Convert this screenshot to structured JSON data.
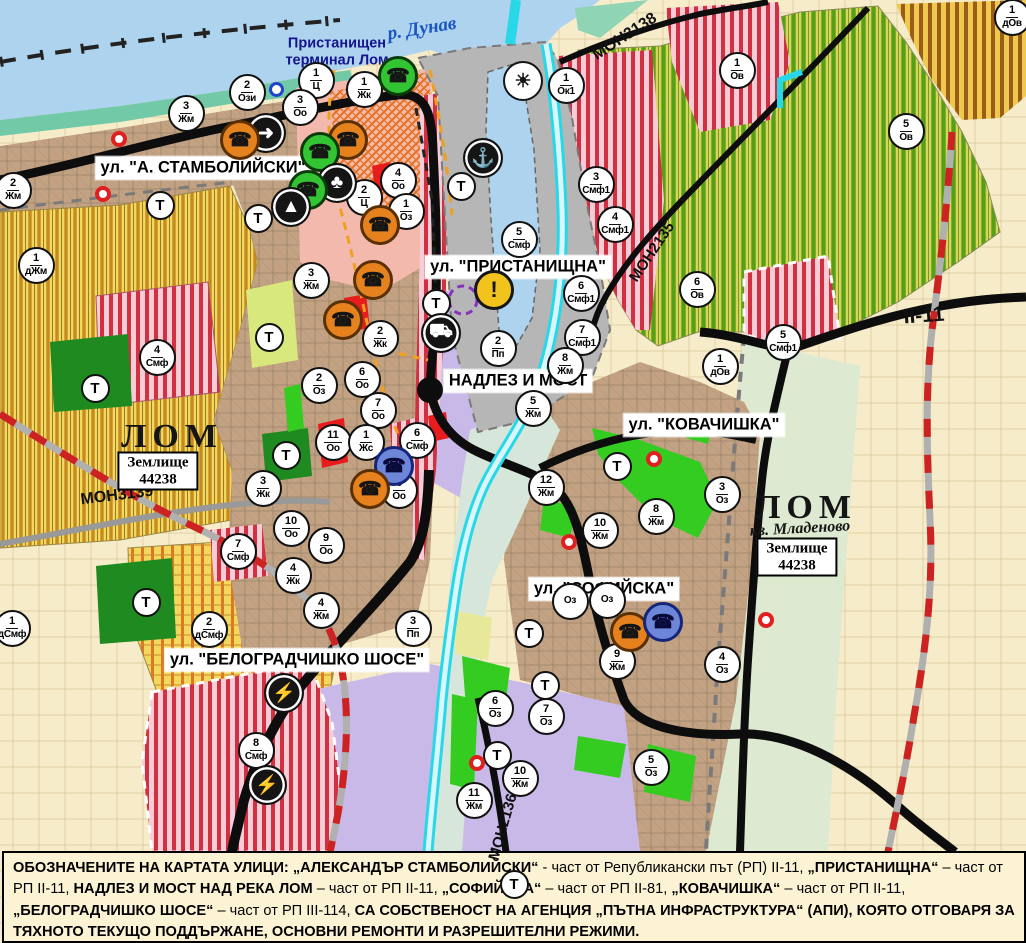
{
  "map": {
    "street_labels": [
      {
        "text": "ул. \"А. СТАМБОЛИЙСКИ\"",
        "x": 203,
        "y": 168
      },
      {
        "text": "ул. \"ПРИСТАНИЩНА\"",
        "x": 518,
        "y": 267
      },
      {
        "text": "НАДЛЕЗ И МОСТ",
        "x": 518,
        "y": 381
      },
      {
        "text": "ул. \"КОВАЧИШКА\"",
        "x": 704,
        "y": 425
      },
      {
        "text": "ул. \"СОФИЙСКА\"",
        "x": 604,
        "y": 589
      },
      {
        "text": "ул. \"БЕЛОГРАДЧИШКО ШОСЕ\"",
        "x": 297,
        "y": 660
      }
    ],
    "place_labels": [
      {
        "kind": "river",
        "text": "р. Дунав",
        "x": 422,
        "y": 29,
        "rot": -9
      },
      {
        "kind": "terminal",
        "text": "Пристанищен\nтерминал Лом",
        "x": 337,
        "y": 52,
        "rot": 0
      },
      {
        "kind": "city",
        "text": "ЛОМ",
        "x": 172,
        "y": 437,
        "rot": 0
      },
      {
        "kind": "city",
        "text": "ЛОМ",
        "x": 806,
        "y": 508,
        "rot": 0
      },
      {
        "kind": "district",
        "text": "кв. Младеново",
        "x": 800,
        "y": 529,
        "rot": -3
      }
    ],
    "road_labels": [
      {
        "text": "МОН3138",
        "x": 625,
        "y": 37,
        "rot": -33,
        "size": 16
      },
      {
        "text": "МОН2135",
        "x": 652,
        "y": 252,
        "rot": -56,
        "size": 15
      },
      {
        "text": "МОН3139",
        "x": 117,
        "y": 496,
        "rot": -7,
        "size": 16
      },
      {
        "text": "МОН2136",
        "x": 503,
        "y": 827,
        "rot": -74,
        "size": 15
      },
      {
        "text": "II-11",
        "x": 924,
        "y": 316,
        "rot": -4,
        "size": 21
      }
    ],
    "area_boxes": [
      {
        "lines": [
          "Землище",
          "44238"
        ],
        "x": 158,
        "y": 471
      },
      {
        "lines": [
          "Землище",
          "44238"
        ],
        "x": 797,
        "y": 557
      }
    ],
    "t_label": "Т",
    "zone_badges": [
      {
        "n": "2",
        "c": "Ози",
        "x": 247,
        "y": 92
      },
      {
        "n": "1",
        "c": "Ц",
        "x": 316,
        "y": 80
      },
      {
        "n": "3",
        "c": "Оо",
        "x": 300,
        "y": 107
      },
      {
        "n": "1",
        "c": "Жк",
        "x": 364,
        "y": 89
      },
      {
        "n": "1",
        "c": "Ок1",
        "x": 566,
        "y": 85
      },
      {
        "n": "1",
        "c": "Ов",
        "x": 737,
        "y": 70
      },
      {
        "n": "1",
        "c": "дОв",
        "x": 1012,
        "y": 17
      },
      {
        "n": "5",
        "c": "Ов",
        "x": 906,
        "y": 131
      },
      {
        "n": "3",
        "c": "Жм",
        "x": 186,
        "y": 113
      },
      {
        "n": "2",
        "c": "Жм",
        "x": 13,
        "y": 190
      },
      {
        "n": "1",
        "c": "дЖм",
        "x": 36,
        "y": 265
      },
      {
        "n": "4",
        "c": "Оо",
        "x": 398,
        "y": 180
      },
      {
        "n": "2",
        "c": "Ц",
        "x": 364,
        "y": 197
      },
      {
        "n": "1",
        "c": "Оз",
        "x": 406,
        "y": 211
      },
      {
        "n": "3",
        "c": "Смф1",
        "x": 596,
        "y": 184
      },
      {
        "n": "4",
        "c": "Смф1",
        "x": 615,
        "y": 224
      },
      {
        "n": "5",
        "c": "Смф",
        "x": 519,
        "y": 239
      },
      {
        "n": "3",
        "c": "Жм",
        "x": 311,
        "y": 280
      },
      {
        "n": "2",
        "c": "Жк",
        "x": 380,
        "y": 338
      },
      {
        "n": "2",
        "c": "Пп",
        "x": 498,
        "y": 348
      },
      {
        "n": "6",
        "c": "Смф1",
        "x": 581,
        "y": 293
      },
      {
        "n": "7",
        "c": "Смф1",
        "x": 582,
        "y": 337
      },
      {
        "n": "6",
        "c": "Ов",
        "x": 697,
        "y": 289
      },
      {
        "n": "1",
        "c": "дОв",
        "x": 720,
        "y": 366
      },
      {
        "n": "5",
        "c": "Смф1",
        "x": 783,
        "y": 342
      },
      {
        "n": "2",
        "c": "Оз",
        "x": 319,
        "y": 385
      },
      {
        "n": "6",
        "c": "Оо",
        "x": 362,
        "y": 379
      },
      {
        "n": "7",
        "c": "Оо",
        "x": 378,
        "y": 410
      },
      {
        "n": "8",
        "c": "Жм",
        "x": 565,
        "y": 365
      },
      {
        "n": "5",
        "c": "Жм",
        "x": 533,
        "y": 408
      },
      {
        "n": "11",
        "c": "Оо",
        "x": 333,
        "y": 442
      },
      {
        "n": "1",
        "c": "Жс",
        "x": 366,
        "y": 442
      },
      {
        "n": "6",
        "c": "Смф",
        "x": 417,
        "y": 440
      },
      {
        "n": "8",
        "c": "Оо",
        "x": 399,
        "y": 490
      },
      {
        "n": "3",
        "c": "Жк",
        "x": 263,
        "y": 488
      },
      {
        "n": "4",
        "c": "Смф",
        "x": 157,
        "y": 357
      },
      {
        "n": "10",
        "c": "Оо",
        "x": 291,
        "y": 528
      },
      {
        "n": "9",
        "c": "Оо",
        "x": 326,
        "y": 545
      },
      {
        "n": "7",
        "c": "Смф",
        "x": 238,
        "y": 551
      },
      {
        "n": "4",
        "c": "Жк",
        "x": 293,
        "y": 575
      },
      {
        "n": "4",
        "c": "Жм",
        "x": 321,
        "y": 610
      },
      {
        "n": "3",
        "c": "Пп",
        "x": 413,
        "y": 628
      },
      {
        "n": "2",
        "c": "дСмф",
        "x": 209,
        "y": 629
      },
      {
        "n": "1",
        "c": "дСмф",
        "x": 12,
        "y": 628
      },
      {
        "n": "12",
        "c": "Жм",
        "x": 546,
        "y": 487
      },
      {
        "n": "10",
        "c": "Жм",
        "x": 600,
        "y": 530
      },
      {
        "n": "8",
        "c": "Жм",
        "x": 656,
        "y": 516
      },
      {
        "n": "3",
        "c": "Оз",
        "x": 722,
        "y": 494
      },
      {
        "n": "9",
        "c": "Жм",
        "x": 617,
        "y": 661
      },
      {
        "n": "4",
        "c": "Оз",
        "x": 722,
        "y": 664
      },
      {
        "n": "6",
        "c": "Оз",
        "x": 495,
        "y": 708
      },
      {
        "n": "7",
        "c": "Оз",
        "x": 546,
        "y": 716
      },
      {
        "n": "10",
        "c": "Жм",
        "x": 520,
        "y": 778
      },
      {
        "n": "11",
        "c": "Жм",
        "x": 474,
        "y": 800
      },
      {
        "n": "5",
        "c": "Оз",
        "x": 651,
        "y": 767
      },
      {
        "n": "8",
        "c": "Смф",
        "x": 256,
        "y": 750
      },
      {
        "n": "",
        "c": "Оз",
        "x": 570,
        "y": 601
      },
      {
        "n": "",
        "c": "Оз",
        "x": 607,
        "y": 600
      }
    ],
    "t_badges": [
      {
        "x": 160,
        "y": 205
      },
      {
        "x": 258,
        "y": 218
      },
      {
        "x": 269,
        "y": 337
      },
      {
        "x": 436,
        "y": 303
      },
      {
        "x": 461,
        "y": 186
      },
      {
        "x": 95,
        "y": 388
      },
      {
        "x": 286,
        "y": 455
      },
      {
        "x": 617,
        "y": 466
      },
      {
        "x": 529,
        "y": 633
      },
      {
        "x": 545,
        "y": 685
      },
      {
        "x": 497,
        "y": 755
      },
      {
        "x": 514,
        "y": 884
      },
      {
        "x": 146,
        "y": 602
      }
    ],
    "icon_badges": [
      {
        "x": 266,
        "y": 133,
        "type": "black",
        "icon": "arrow-icon",
        "glyph": "➜"
      },
      {
        "x": 240,
        "y": 140,
        "type": "orange",
        "icon": "phone-icon",
        "glyph": "☎"
      },
      {
        "x": 348,
        "y": 140,
        "type": "orange",
        "icon": "phone-icon",
        "glyph": "☎"
      },
      {
        "x": 320,
        "y": 152,
        "type": "green",
        "icon": "phone-icon",
        "glyph": "☎"
      },
      {
        "x": 398,
        "y": 76,
        "type": "green",
        "icon": "phone-icon",
        "glyph": "☎"
      },
      {
        "x": 523,
        "y": 81,
        "type": "white",
        "icon": "sun-icon",
        "glyph": "☀"
      },
      {
        "x": 337,
        "y": 183,
        "type": "black",
        "icon": "club-icon",
        "glyph": "♣"
      },
      {
        "x": 308,
        "y": 190,
        "type": "green",
        "icon": "phone-icon",
        "glyph": "☎"
      },
      {
        "x": 291,
        "y": 207,
        "type": "black",
        "icon": "mountain-icon",
        "glyph": "▲"
      },
      {
        "x": 380,
        "y": 225,
        "type": "orange",
        "icon": "phone-icon",
        "glyph": "☎"
      },
      {
        "x": 373,
        "y": 280,
        "type": "orange",
        "icon": "phone-icon",
        "glyph": "☎"
      },
      {
        "x": 343,
        "y": 320,
        "type": "orange",
        "icon": "phone-icon",
        "glyph": "☎"
      },
      {
        "x": 483,
        "y": 158,
        "type": "black",
        "icon": "anchor-icon",
        "glyph": "⚓"
      },
      {
        "x": 441,
        "y": 333,
        "type": "black",
        "icon": "truck-icon",
        "glyph": "⛟"
      },
      {
        "x": 494,
        "y": 290,
        "type": "yellow",
        "icon": "warning-icon",
        "glyph": "!"
      },
      {
        "x": 394,
        "y": 466,
        "type": "blue",
        "icon": "phone-icon",
        "glyph": "☎"
      },
      {
        "x": 370,
        "y": 489,
        "type": "orange",
        "icon": "phone-icon",
        "glyph": "☎"
      },
      {
        "x": 630,
        "y": 632,
        "type": "orange",
        "icon": "phone-icon",
        "glyph": "☎"
      },
      {
        "x": 663,
        "y": 622,
        "type": "blue",
        "icon": "phone-icon",
        "glyph": "☎"
      },
      {
        "x": 284,
        "y": 693,
        "type": "black",
        "icon": "lightning-icon",
        "glyph": "⚡"
      },
      {
        "x": 267,
        "y": 785,
        "type": "black",
        "icon": "lightning-icon",
        "glyph": "⚡"
      }
    ],
    "red_dots": [
      {
        "x": 119,
        "y": 139
      },
      {
        "x": 103,
        "y": 194
      },
      {
        "x": 654,
        "y": 459
      },
      {
        "x": 569,
        "y": 542
      },
      {
        "x": 477,
        "y": 763
      },
      {
        "x": 766,
        "y": 620
      }
    ],
    "blue_ring": {
      "x": 277,
      "y": 90
    },
    "colors": {
      "danube": "#aed3ee",
      "port": "#b6b6b6",
      "urban": "#c3a183",
      "lavender": "#c9b9e8",
      "park_green": "#35cc22",
      "forest_green": "#1f8a1f",
      "smf_stripe": "#d03040",
      "ov_stripe": "#55a016",
      "road": "#0d0d0d",
      "river": "#28d8e8",
      "route_dash": "#cc2222"
    }
  },
  "footer": {
    "segments": [
      {
        "text": "ОБОЗНАЧЕНИТЕ НА КАРТАТА УЛИЦИ: „АЛЕКСАНДЪР СТАМБОЛИЙСКИ“",
        "bold": true
      },
      {
        "text": " - част от Републикански път (РП) II-11, ",
        "bold": false
      },
      {
        "text": "„ПРИСТАНИЩНА“",
        "bold": true
      },
      {
        "text": " – част от РП II-11, ",
        "bold": false
      },
      {
        "text": "НАДЛЕЗ И МОСТ НАД РЕКА ЛОМ",
        "bold": true
      },
      {
        "text": " – част от РП II-11, ",
        "bold": false
      },
      {
        "text": "„СОФИЙСКА“",
        "bold": true
      },
      {
        "text": " – част от РП II-81, ",
        "bold": false
      },
      {
        "text": "„КОВАЧИШКА“",
        "bold": true
      },
      {
        "text": " – част от РП II-11, ",
        "bold": false
      },
      {
        "text": "„БЕЛОГРАДЧИШКО ШОСЕ“",
        "bold": true
      },
      {
        "text": " – част от РП III-114, ",
        "bold": false
      },
      {
        "text": "СА СОБСТВЕНОСТ НА АГЕНЦИЯ „ПЪТНА ИНФРАСТРУКТУРА“ (АПИ), КОЯТО ОТГОВАРЯ ЗА ТЯХНОТО ТЕКУЩО ПОДДЪРЖАНЕ, ОСНОВНИ РЕМОНТИ И РАЗРЕШИТЕЛНИ РЕЖИМИ.",
        "bold": true
      }
    ]
  }
}
